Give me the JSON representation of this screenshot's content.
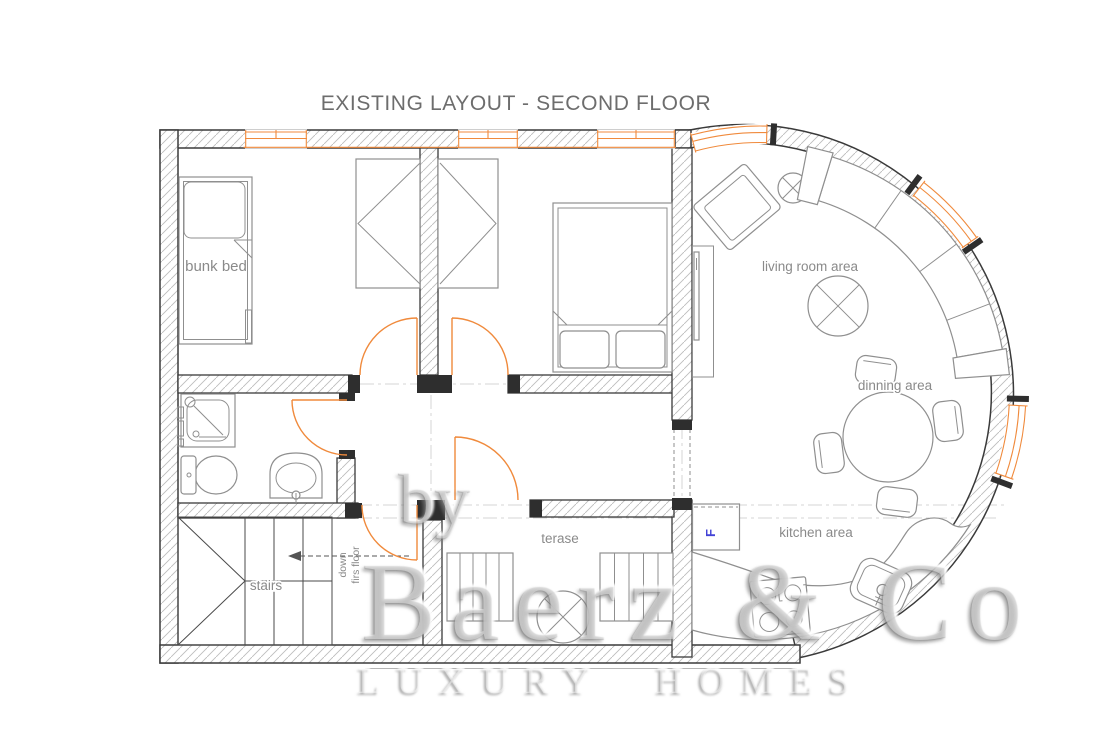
{
  "title": "EXISTING LAYOUT - SECOND FLOOR",
  "plan": {
    "room_labels": {
      "bunk_bed": "bunk bed",
      "living_room": "living room area",
      "dining": "dinning area",
      "terrace": "terase",
      "kitchen": "kitchen area",
      "stairs": "stairs"
    },
    "annotations": {
      "stairs_down_line1": "down",
      "stairs_down_line2": "firs floor",
      "fridge_abbrev": "F"
    }
  },
  "watermark": {
    "prefix": "by",
    "brand": "Baerz & Co",
    "tagline": "LUXURY HOMES"
  },
  "colors": {
    "wall_outline": "#3a3a3a",
    "wall_hatch": "#bdbdbd",
    "furniture": "#8f8f8f",
    "openings_orange": "#f08a3c",
    "labels": "#8a8a8a",
    "title": "#6d6d6d",
    "fridge_blue": "#4343d6",
    "watermark_gray": "#bfbfbf"
  }
}
